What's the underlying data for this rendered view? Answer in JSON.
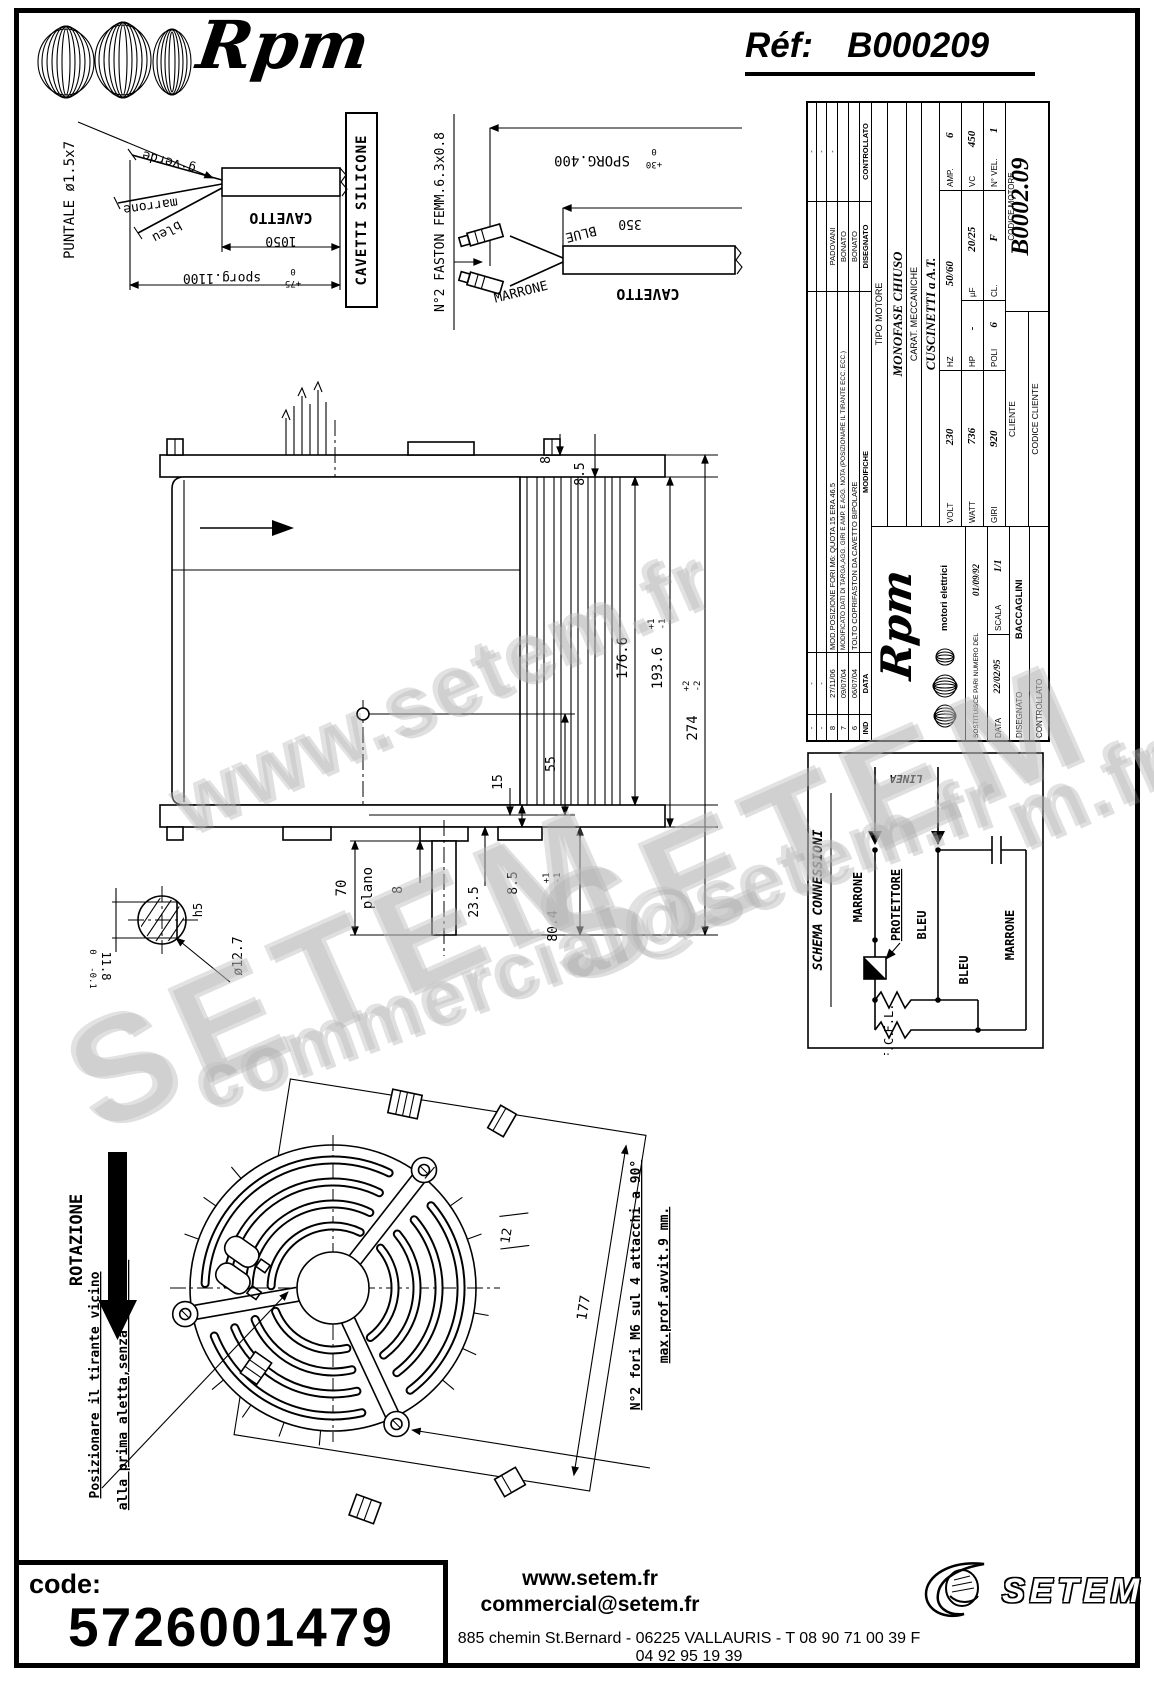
{
  "colors": {
    "ink": "#000000",
    "paper": "#ffffff",
    "watermark": "#bdbdbd"
  },
  "header": {
    "brand": "Rpm",
    "ref_label": "Réf:",
    "ref_value": "B000209"
  },
  "cable_left": {
    "puntale": "PUNTALE ø1.5x7",
    "verde": "g·verde",
    "marrone": "marrone",
    "bleu": "bleu",
    "cavetto": "CAVETTO",
    "dim_1050": "1050",
    "sporg": "sporg.1100",
    "sporg_tol_hi": "0",
    "sporg_tol_lo": "+75",
    "silicone": "CAVETTI SILICONE"
  },
  "cable_right": {
    "faston": "N°2 FASTON FEMM.6.3x0.8",
    "sporg": "SPORG.400",
    "tol_hi": "0",
    "tol_lo": "+30",
    "dim_350": "350",
    "cavetto": "CAVETTO",
    "blue": "BLUE",
    "marrone": "MARRONE"
  },
  "side_view": {
    "dim_8_top": "8",
    "dim_85_top": "8.5",
    "dim_1766": "176.6",
    "dim_1936": "193.6",
    "dim_1936_hi": "+1",
    "dim_1936_lo": "-1",
    "dim_274": "274",
    "dim_274_hi": "+2",
    "dim_274_lo": "-2",
    "dim_55": "55",
    "dim_15": "15",
    "dim_235": "23.5",
    "dim_85_bot": "8.5",
    "dim_8_bot": "8",
    "dim_804": "80.4",
    "dim_804_hi": "+1",
    "dim_804_lo": "-1",
    "dim_70": "70",
    "plano": "plano",
    "shaft_d": "ø12.7",
    "shaft_h5": "h5",
    "shaft_flat": "11.8",
    "shaft_flat_hi": "0",
    "shaft_flat_lo": "-0.1"
  },
  "front_view": {
    "rotazione": "ROTAZIONE",
    "nota1": "Posizionare il tirante vicino",
    "nota2": "alla prima aletta,senza toccarla",
    "dim_12": "12",
    "dim_177": "177",
    "fori1": "N°2 fori M6 sul 4 attacchi a 90°",
    "fori2": "max.prof.avvit.9 mm."
  },
  "title_block": {
    "revisions": [
      {
        "ind": "-",
        "date": "-",
        "mod": "",
        "who": "",
        "chk": "-"
      },
      {
        "ind": "-",
        "date": "-",
        "mod": "",
        "who": "",
        "chk": "-"
      },
      {
        "ind": "8",
        "date": "27/11/06",
        "mod": "MOD.POSIZIONE FORI M6: QUOTA 15 ERA 46.5",
        "who": "PADOVANI",
        "chk": "-"
      },
      {
        "ind": "7",
        "date": "09/07/04",
        "mod": "MODIFICATO DATI DI TARGA,AGG. GIRI E AMP. E AGG. NOTA (POSIZIONARE IL TIRANTE ECC. ECC.)",
        "who": "BONATO",
        "chk": ""
      },
      {
        "ind": "6",
        "date": "06/07/04",
        "mod": "TOLTO COPRIFASTON DA CAVETTO BIPOLARE",
        "who": "BONATO",
        "chk": ""
      }
    ],
    "rev_header": {
      "ind": "IND",
      "date": "DATA",
      "mod": "MODIFICHE",
      "who": "DISEGNATO",
      "chk": "CONTROLLATO"
    },
    "tipo_label": "TIPO MOTORE",
    "tipo": "MONOFASE CHIUSO",
    "carat_label": "CARAT. MECCANICHE",
    "carat": "CUSCINETTI a A.T.",
    "volt_label": "VOLT",
    "volt": "230",
    "hz_label": "HZ",
    "hz": "50/60",
    "amp_label": "AMP.",
    "amp": "6",
    "watt_label": "WATT",
    "watt": "736",
    "hp_label": "HP",
    "hp": "-",
    "uf_label": "µF",
    "uf": "20/25",
    "vc_label": "VC",
    "vc": "450",
    "giri_label": "GIRI",
    "giri": "920",
    "poli_label": "POLI",
    "poli": "6",
    "cl_label": "CL.",
    "cl": "F",
    "vel_label": "N° VEL.",
    "vel": "1",
    "cliente_label": "CLIENTE",
    "codice_motore_label": "CODICE MOTORE",
    "codice_motore": "B0002.09",
    "codice_cliente_label": "CODICE CLIENTE",
    "logo_brand": "Rpm",
    "logo_sub": "motori elettrici",
    "sost_label": "SOSTITUISCE PARI NUMERO DEL",
    "sost_date": "01/09/92",
    "data_label": "DATA",
    "data": "22/02/95",
    "scala_label": "SCALA",
    "scala": "1/1",
    "disegnato_label": "DISEGNATO",
    "disegnato": "BACCAGLINI",
    "controllato_label": "CONTROLLATO"
  },
  "schema": {
    "title": "SCHEMA CONNESSIONI",
    "linea": "LINEA",
    "marrone1": "MARRONE",
    "protettore": "PROTETTORE",
    "bleu1": "BLEU",
    "bleu2": "BLEU",
    "marrone2": "MARRONE",
    "fl": "F.L.",
    "fc": "F.C."
  },
  "watermark": {
    "w1": "www.setem.fr",
    "w2": "SETEM",
    "w3": "SETEM",
    "w4": "commercial@setem.fr",
    "w5": "m.fr"
  },
  "footer": {
    "code_label": "code:",
    "code": "5726001479",
    "site": "www.setem.fr",
    "email": "commercial@setem.fr",
    "address": "885 chemin St.Bernard  -  06225 VALLAURIS  -  T 08 90 71 00 39   F 04 92 95 19 39",
    "logo": "SETEM"
  }
}
